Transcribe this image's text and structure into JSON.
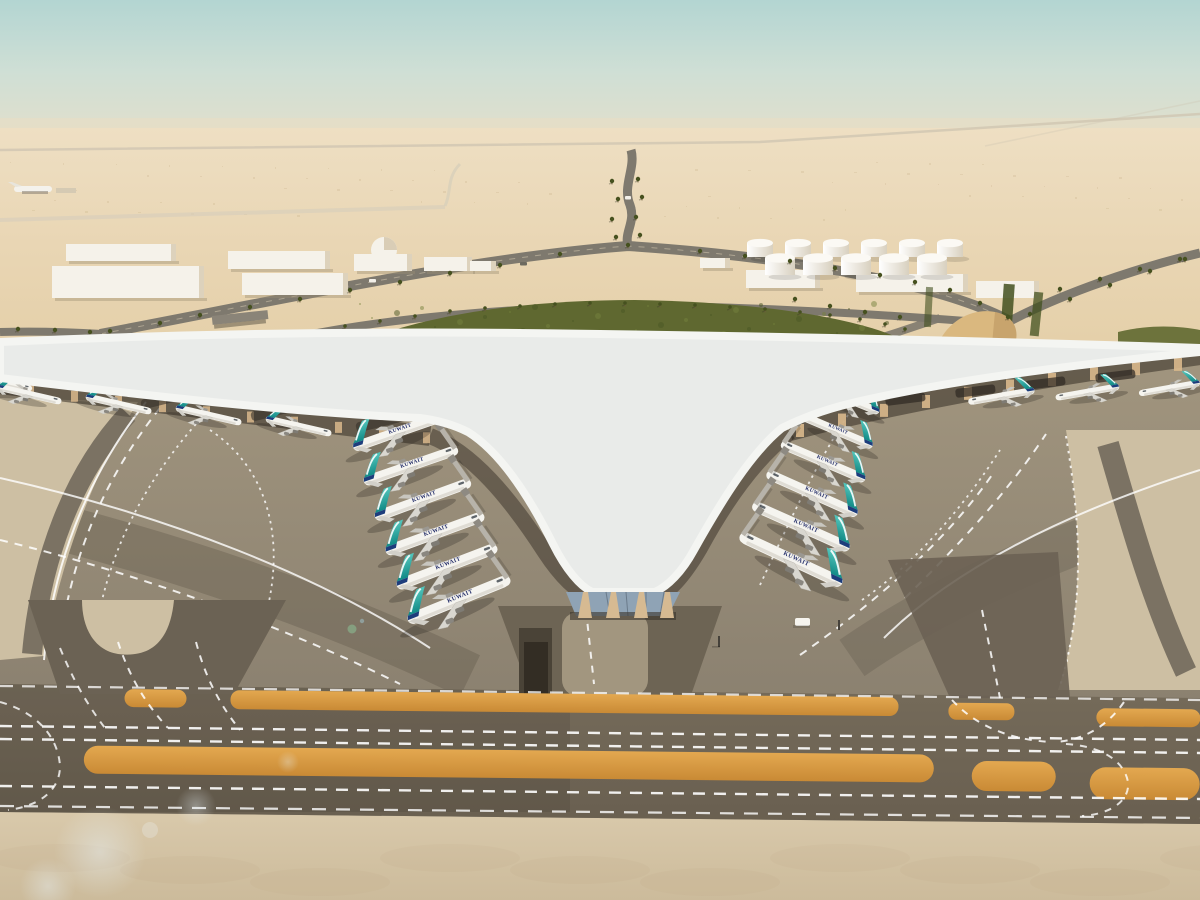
{
  "scene": {
    "title": "airport-terminal-aerial-render",
    "airline_label": "KUWAIT",
    "colors": {
      "sky_top": "#b3d5d2",
      "sky_mid": "#cfdfd5",
      "horizon_haze": "#e9dcc2",
      "desert_far": "#eedfc3",
      "desert": "#e7d3ae",
      "road_asphalt": "#7e796e",
      "road_light": "#cdc2a9",
      "vegetation": "#5f6830",
      "palm_green": "#46511f",
      "roof_base": "#e9ebe9",
      "roof_rib": "#b9c0c5",
      "glass_light": "#a9c1de",
      "glass_dark": "#7d9cc6",
      "fascia_white": "#f4f5f2",
      "gap_shadow": "#352e25",
      "arch_tan": "#d9b88c",
      "apron_top": "#a2967f",
      "apron_bottom": "#8b8170",
      "island_beige": "#cdbfa3",
      "island_stripe": "#7b7263",
      "lane_dark": "#5e5748",
      "taxiway_band": "#6f6555",
      "sand_strip": "#db9d46",
      "bottom_concrete": "#d5c5a7",
      "fuselage_white": "#f5f4ef",
      "fuselage_shade": "#d9d6cd",
      "tail_teal_light": "#54c6bc",
      "tail_teal_dark": "#118a86",
      "tail_navy": "#1d3d7c",
      "label_navy": "#26306b",
      "building_white": "#f5f2ea",
      "tank_white": "#fbf9f4",
      "dune_tan": "#dab87f",
      "glow_warm": "#ffe8c2"
    }
  }
}
